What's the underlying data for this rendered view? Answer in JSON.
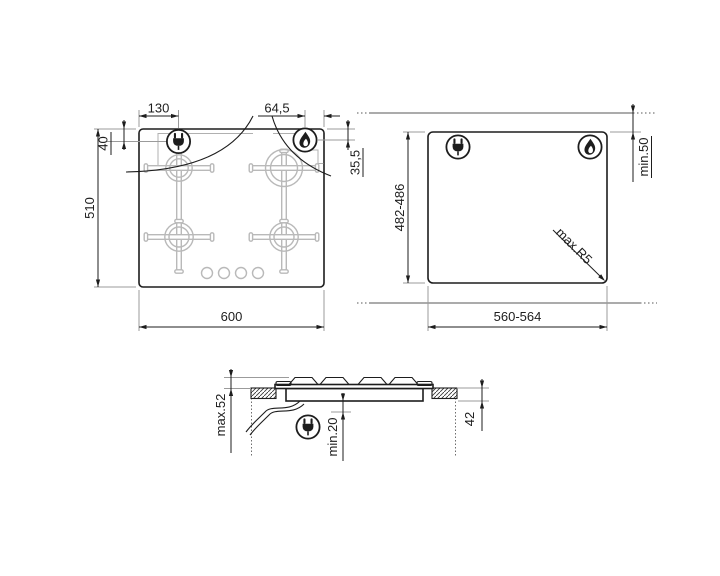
{
  "hob_top": {
    "width": "600",
    "depth": "510",
    "plug_offset_left": "130",
    "plug_offset_top": "40",
    "gas_offset_right": "64,5",
    "gas_offset_top": "35,5"
  },
  "cutout": {
    "width": "560-564",
    "depth": "482-486",
    "rear_clearance": "min.50",
    "corner_radius": "max.R5"
  },
  "side_profile": {
    "height_above": "max.52",
    "clearance_below": "min.20",
    "depth_below_worktop": "42"
  },
  "icons": {
    "plug": "electrical-connection-icon",
    "flame": "gas-connection-icon"
  },
  "colors": {
    "line": "#1d1d1d",
    "construction": "#9b9b9b",
    "grate": "#b9b9b9",
    "worktop_line": "#8f8f8f",
    "background": "#ffffff"
  }
}
